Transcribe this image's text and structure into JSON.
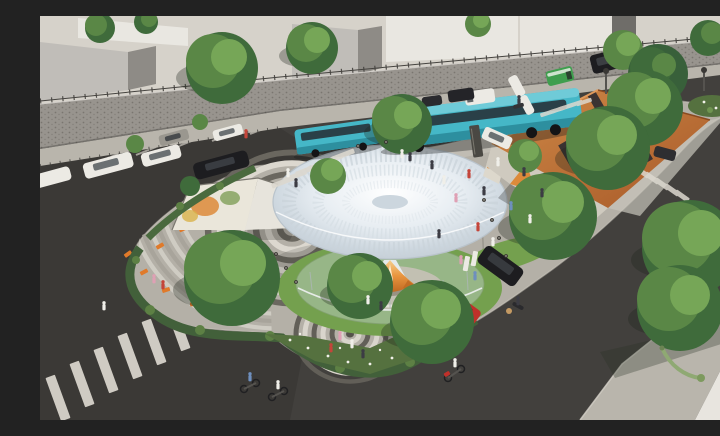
{
  "scene": {
    "type": "architectural-aerial-render",
    "description": "Daytime aerial rendering of an urban pocket-park plaza: a white funnel-shaped canopy pavilion over a glass drum, spiral and concentric-circle paving, curved amphitheater steps with orange benches, angular mural walls, a copper-roofed pavilion with skylights, hedges and flower beds, surrounded by streets with teal buses, parked cars, crosswalks, cyclists and pedestrians; grey buildings behind a stone retaining wall with a fence at the top.",
    "elements": [
      "funnel-canopy-pavilion",
      "glass-enclosure",
      "orange-petal-core",
      "spiral-paving",
      "concentric-circle-plaza",
      "amphitheater-steps",
      "orange-benches",
      "mural-wall-west",
      "copper-roof-pavilion",
      "retaining-wall-with-fence",
      "background-buildings",
      "street-trees",
      "hedge-border",
      "flower-beds",
      "teal-buses",
      "white-van",
      "green-van",
      "parked-cars",
      "red-hatchback",
      "black-suv",
      "wayfinding-totems",
      "entry-sign",
      "crosswalks",
      "cyclists",
      "scooter-riders",
      "pedestrians",
      "street-lamps",
      "bollards",
      "corner-sidewalk"
    ],
    "inventory": {
      "buses": 2,
      "crosswalks": 4,
      "mural_walls": 2,
      "amphitheater_benches": 6,
      "cyclists": 2,
      "scooter_riders": 3,
      "pedestrians_visible": 29
    }
  },
  "palette": {
    "asphalt": "#42403d",
    "terrace": "#d6d2ca",
    "sidewalk": "#b9b5ac",
    "paver": "#b4b0a7",
    "paverLight": "#c8c4bb",
    "buildingFront": "#c0bdb8",
    "buildingSide": "#8e8b86",
    "buildingWhite": "#e9e7e1",
    "buildingBright": "#e8e5df",
    "buildingDark": "#6f6d69",
    "wallStone": "#98948e",
    "wallSpeckle": "#6e6a64",
    "fence": "#45433f",
    "grass": "#74a04e",
    "grassDark": "#55713f",
    "hedge": "#42603a",
    "treeDark": "#3f6b3b",
    "treeMid": "#5a8746",
    "treeLight": "#76a657",
    "conifer": "#38603a",
    "flowerWhite": "#f2f1ea",
    "canopyCenter": "#ffffff",
    "canopyMid": "#e7edf2",
    "canopyRim": "#ccd6de",
    "canopyEdge": "#b9c3cb",
    "glowLight": "#f6cf8e",
    "glowMid": "#e8943e",
    "glowDeep": "#c06a22",
    "glass": "#cdd8dc",
    "busTeal": "#45b7c7",
    "busTealLight": "#6fcbd8",
    "busTealDark": "#2d8f9f",
    "busWindow": "#27333a",
    "vanGreen": "#3f9e4e",
    "roofCopper": "#a85928",
    "roofCopperLight": "#cf8a48",
    "skylight": "#2c2c31",
    "muralOrange": "#dd8a3a",
    "muralGreen": "#7f9f57",
    "muralYellow": "#d9b34a",
    "muralCream": "#eae6da",
    "bench": "#e07a2a",
    "carWhite": "#eceae4",
    "carBlack": "#1d1d20",
    "carGrey": "#9a978f",
    "carRed": "#c0302a",
    "stripe": "#dcd8cf",
    "signDark": "#4a4843",
    "lampGreen": "#8fa973",
    "shadow": "#23261f",
    "personRed": "#c4453a",
    "personPink": "#dfa0b4",
    "personBlue": "#6e8fbe",
    "personDark": "#3c3c44",
    "personWhite": "#f0efe9"
  }
}
